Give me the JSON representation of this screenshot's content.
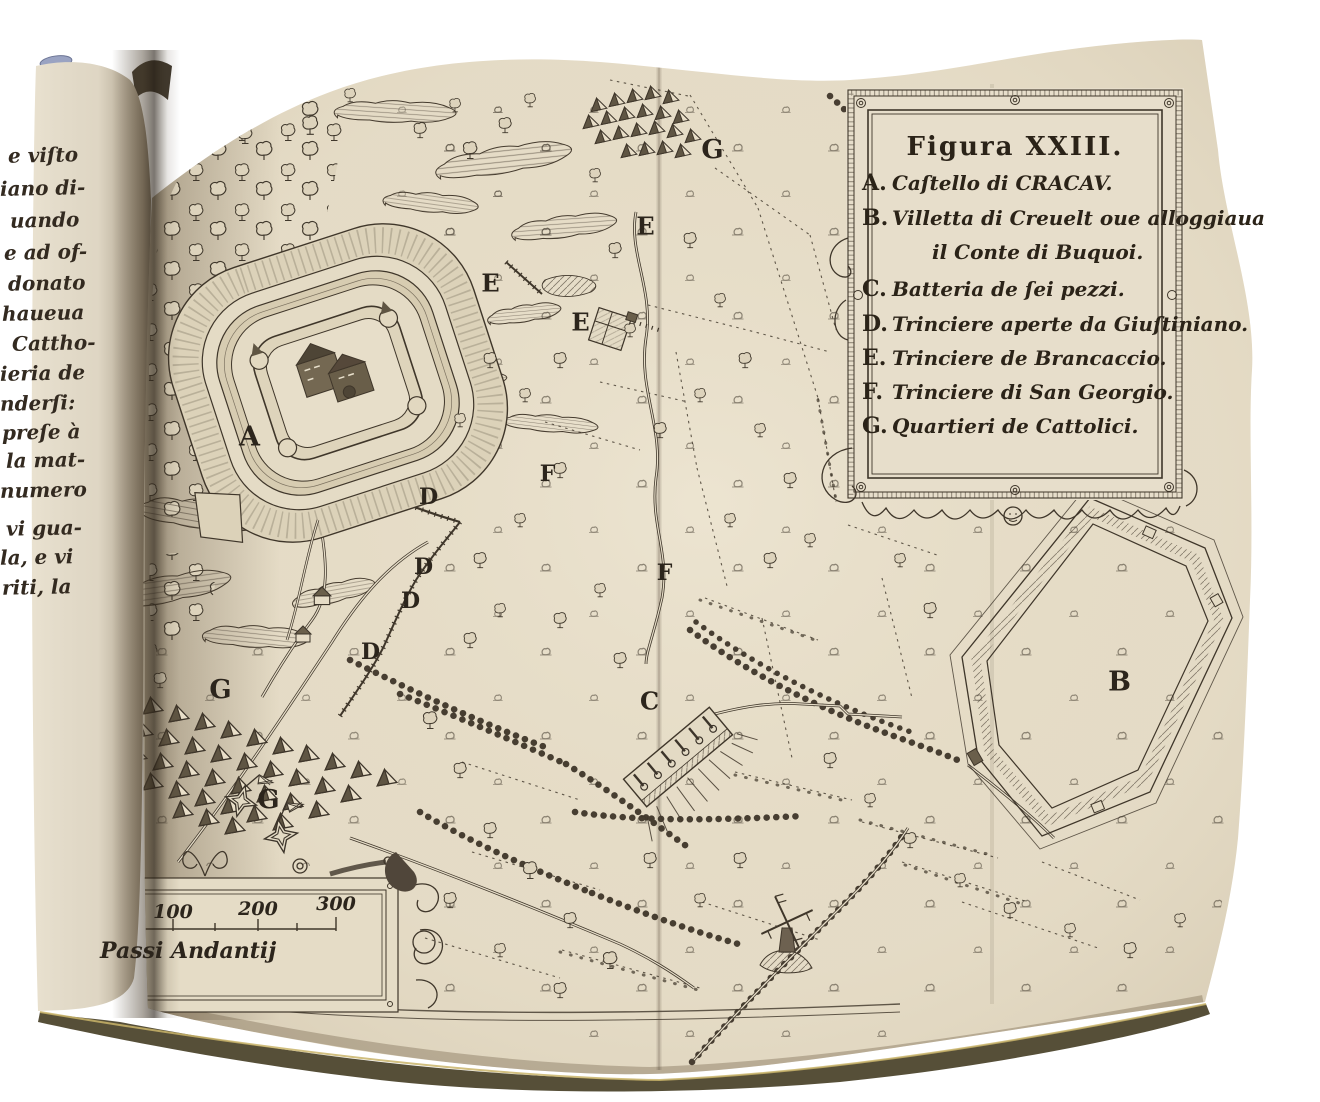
{
  "figure": {
    "legend": {
      "title": "Figura XXIII.",
      "entries": [
        {
          "key": "A.",
          "text": "Caſtello di CRACAV."
        },
        {
          "key": "B.",
          "text": "Villetta di Creuelt oue alloggiaua",
          "text2": "il Conte di Buquoi."
        },
        {
          "key": "C.",
          "text": "Batteria de ſei pezzi."
        },
        {
          "key": "D.",
          "text": "Trinciere aperte da Giuſtiniano."
        },
        {
          "key": "E.",
          "text": "Trinciere de Brancaccio."
        },
        {
          "key": "F.",
          "text": "Trinciere di San Georgio."
        },
        {
          "key": "G.",
          "text": "Quartieri de Cattolici."
        }
      ]
    },
    "scale_bar": {
      "labels": [
        "100",
        "200",
        "300"
      ],
      "caption": "Passi Andantij"
    },
    "markers": [
      "A",
      "B",
      "C",
      "D",
      "D",
      "D",
      "D",
      "E",
      "E",
      "E",
      "F",
      "F",
      "G",
      "G",
      "G"
    ]
  },
  "left_page": {
    "fragments": [
      "e viſto",
      "iano di-",
      "uando",
      "e ad of-",
      "donato",
      "haueua",
      "Cattho-",
      "ieria de",
      "nderſi:",
      "preſe à",
      "la mat-",
      "numero",
      "vi gua-",
      "la, e vi",
      "riti, la"
    ]
  },
  "palette": {
    "ink": "#3f362a",
    "paper": "#e6ddc8",
    "left_page_paper": "#eae2d0",
    "cover_edge": "#564f38",
    "headband": "#9aa3c2"
  }
}
